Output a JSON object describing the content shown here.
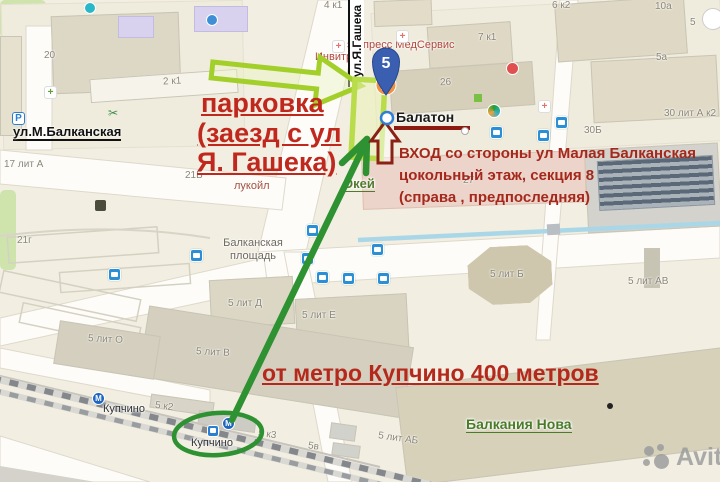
{
  "map": {
    "streets": {
      "m_balkanskaya": "ул.М.Балканская",
      "ya_gasheka": "ул.Я.Гашека"
    },
    "square": {
      "line1": "Балканская",
      "line2": "площадь"
    },
    "poi": {
      "invitro": "Инвитро",
      "medservice": "экспресс МедСервис",
      "balaton": "Балатон",
      "okey": "Окей",
      "lukoil": "лукойл",
      "balkania_nova": "Балкания Нова",
      "kupchino_metro": "Купчино",
      "kupchino_rail": "Купчино"
    },
    "building_labels": [
      "20",
      "2 к1",
      "4 к1",
      "6 к2",
      "10а",
      "5",
      "5а",
      "7 к1",
      "26",
      "30Б",
      "30 лит А к2",
      "17 лит А",
      "21г",
      "21Б",
      "27",
      "5 лит Д",
      "5 лит Е",
      "5 лит Б",
      "5 лит АВ",
      "5 лит О",
      "5 лит В",
      "5 к2",
      "5 к3",
      "5в",
      "5 лит АБ"
    ],
    "marker": {
      "number": "5"
    },
    "icon_glyphs": {
      "metro": "М",
      "parking": "Р",
      "scissors": "✂",
      "pharmacy": "+"
    }
  },
  "annotations": {
    "parking": {
      "line1": "парковка",
      "line2": "(заезд с ул",
      "line3": "Я. Гашека)",
      "color": "#c0281e"
    },
    "entrance": {
      "line1": "ВХОД со стороны ул Малая Балканская",
      "line2": "цокольный этаж, секция 8",
      "line3": "(справа , предпоследняя)",
      "color": "#a5281c"
    },
    "metro_distance": {
      "text": "от метро Купчино 400 метров",
      "color": "#b5281c"
    },
    "colors": {
      "route_green": "#2e9132",
      "lime": "#a3cf2a",
      "dark_red": "#8b2015",
      "balaton_underline": "#8b1a10"
    }
  },
  "watermark": {
    "text": "Avito"
  }
}
